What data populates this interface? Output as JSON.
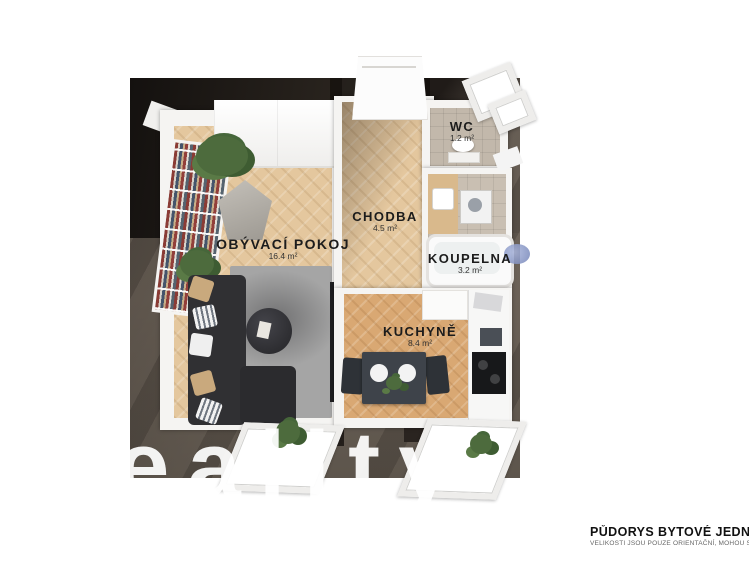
{
  "image": {
    "kind": "3d-floor-plan-render",
    "width": 749,
    "height": 562
  },
  "watermark": {
    "text": "eality"
  },
  "caption": {
    "title": "PŮDORYS BYTOVÉ JEDNO",
    "disclaimer": "VELIKOSTI JSOU POUZE ORIENTAČNÍ, MOHOU SE LIŠ"
  },
  "rooms": [
    {
      "name": "OBÝVACÍ POKOJ",
      "area": "16.4 m²"
    },
    {
      "name": "CHODBA",
      "area": "4.5 m²"
    },
    {
      "name": "WC",
      "area": "1.2 m²"
    },
    {
      "name": "KOUPELNA",
      "area": "3.2 m²"
    },
    {
      "name": "KUCHYNĚ",
      "area": "8.4 m²"
    }
  ],
  "colors": {
    "ground": "#6b6157",
    "shadow": "#1d1a17",
    "wood_floor": "#e4c79e",
    "kitchen_floor": "#d9a873",
    "tile_floor": "#c2b8ab",
    "wall": "#f5f4f2",
    "sofa": "#303033",
    "pillow_tan": "#c9a97d",
    "watermark": "#ffffff",
    "caption_text": "#111111"
  }
}
